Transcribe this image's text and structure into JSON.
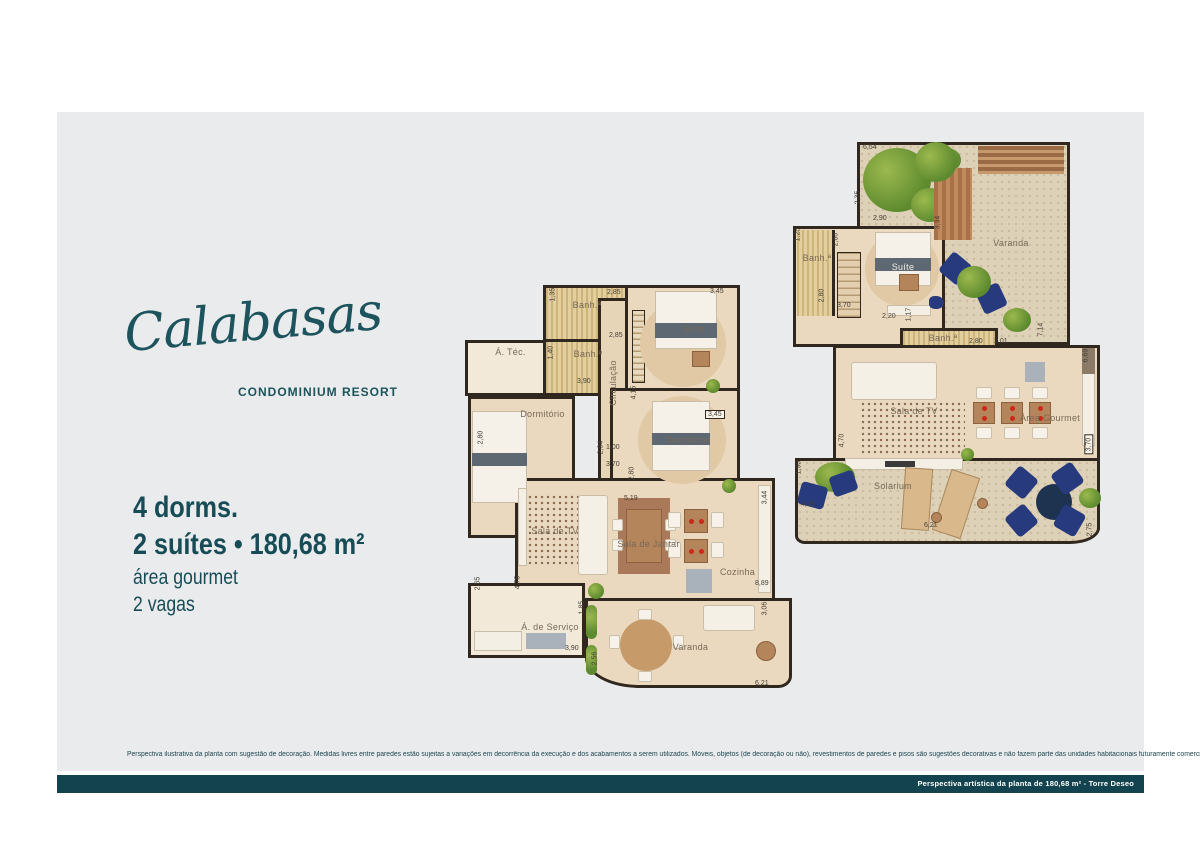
{
  "brand": {
    "logo": "Calabasas",
    "tagline": "CONDOMINIUM RESORT"
  },
  "specs": {
    "line1": "4 dorms.",
    "line2": "2 suítes • 180,68 m²",
    "line3": "área gourmet",
    "line4": "2 vagas"
  },
  "disclaimer": "Perspectiva ilustrativa da planta com sugestão de decoração. Medidas livres entre paredes estão sujeitas a variações em decorrência da execução e dos acabamentos a serem utilizados. Móveis, objetos (de decoração ou não), revestimentos de paredes e pisos são sugestões decorativas e não fazem parte das unidades habitacionais futuramente comercializadas.",
  "footer": {
    "caption": "Perspectiva artística da planta de 180,68 m²  -  Torre Deseo"
  },
  "colors": {
    "accent_teal": "#174c57",
    "footer_bar": "#12434e",
    "panel_gray": "#e9ebec",
    "wall": "#30271f",
    "floor_beige": "#ebd9bf"
  },
  "fp1": {
    "rooms": [
      "Banh.ª",
      "Banh.ª",
      "Á. Téc.",
      "Suíte",
      "Dormitório",
      "Circulação",
      "Dormitório",
      "Sala de TV",
      "Sala de Jantar",
      "Cozinha",
      "Á. de Serviço",
      "Varanda"
    ],
    "dims": [
      "1,35",
      "2,85",
      "3,45",
      "2,85",
      "1,40",
      "3,90",
      "2,80",
      "4,15",
      "2,94",
      "1,00",
      "3,70",
      "3,45",
      "2,80",
      "5,19",
      "3,44",
      "8,89",
      "4,75",
      "2,65",
      "1,85",
      "3,90",
      "2,56",
      "3,06",
      "6,21"
    ]
  },
  "fp2": {
    "rooms": [
      "Varanda",
      "Banh.ª",
      "Suíte",
      "Banh.ª",
      "Sala de TV",
      "Área Gourmet",
      "Solarium"
    ],
    "dims": [
      "6,54",
      "2,35",
      "2,90",
      "3,34",
      "1,25",
      "2,80",
      "2,80",
      "3,70",
      "2,20",
      "1,17",
      "2,80",
      "2,01",
      "7,14",
      "6,69",
      "4,70",
      "3,70",
      "1,90",
      "4,09",
      "6,21",
      "2,75"
    ]
  }
}
